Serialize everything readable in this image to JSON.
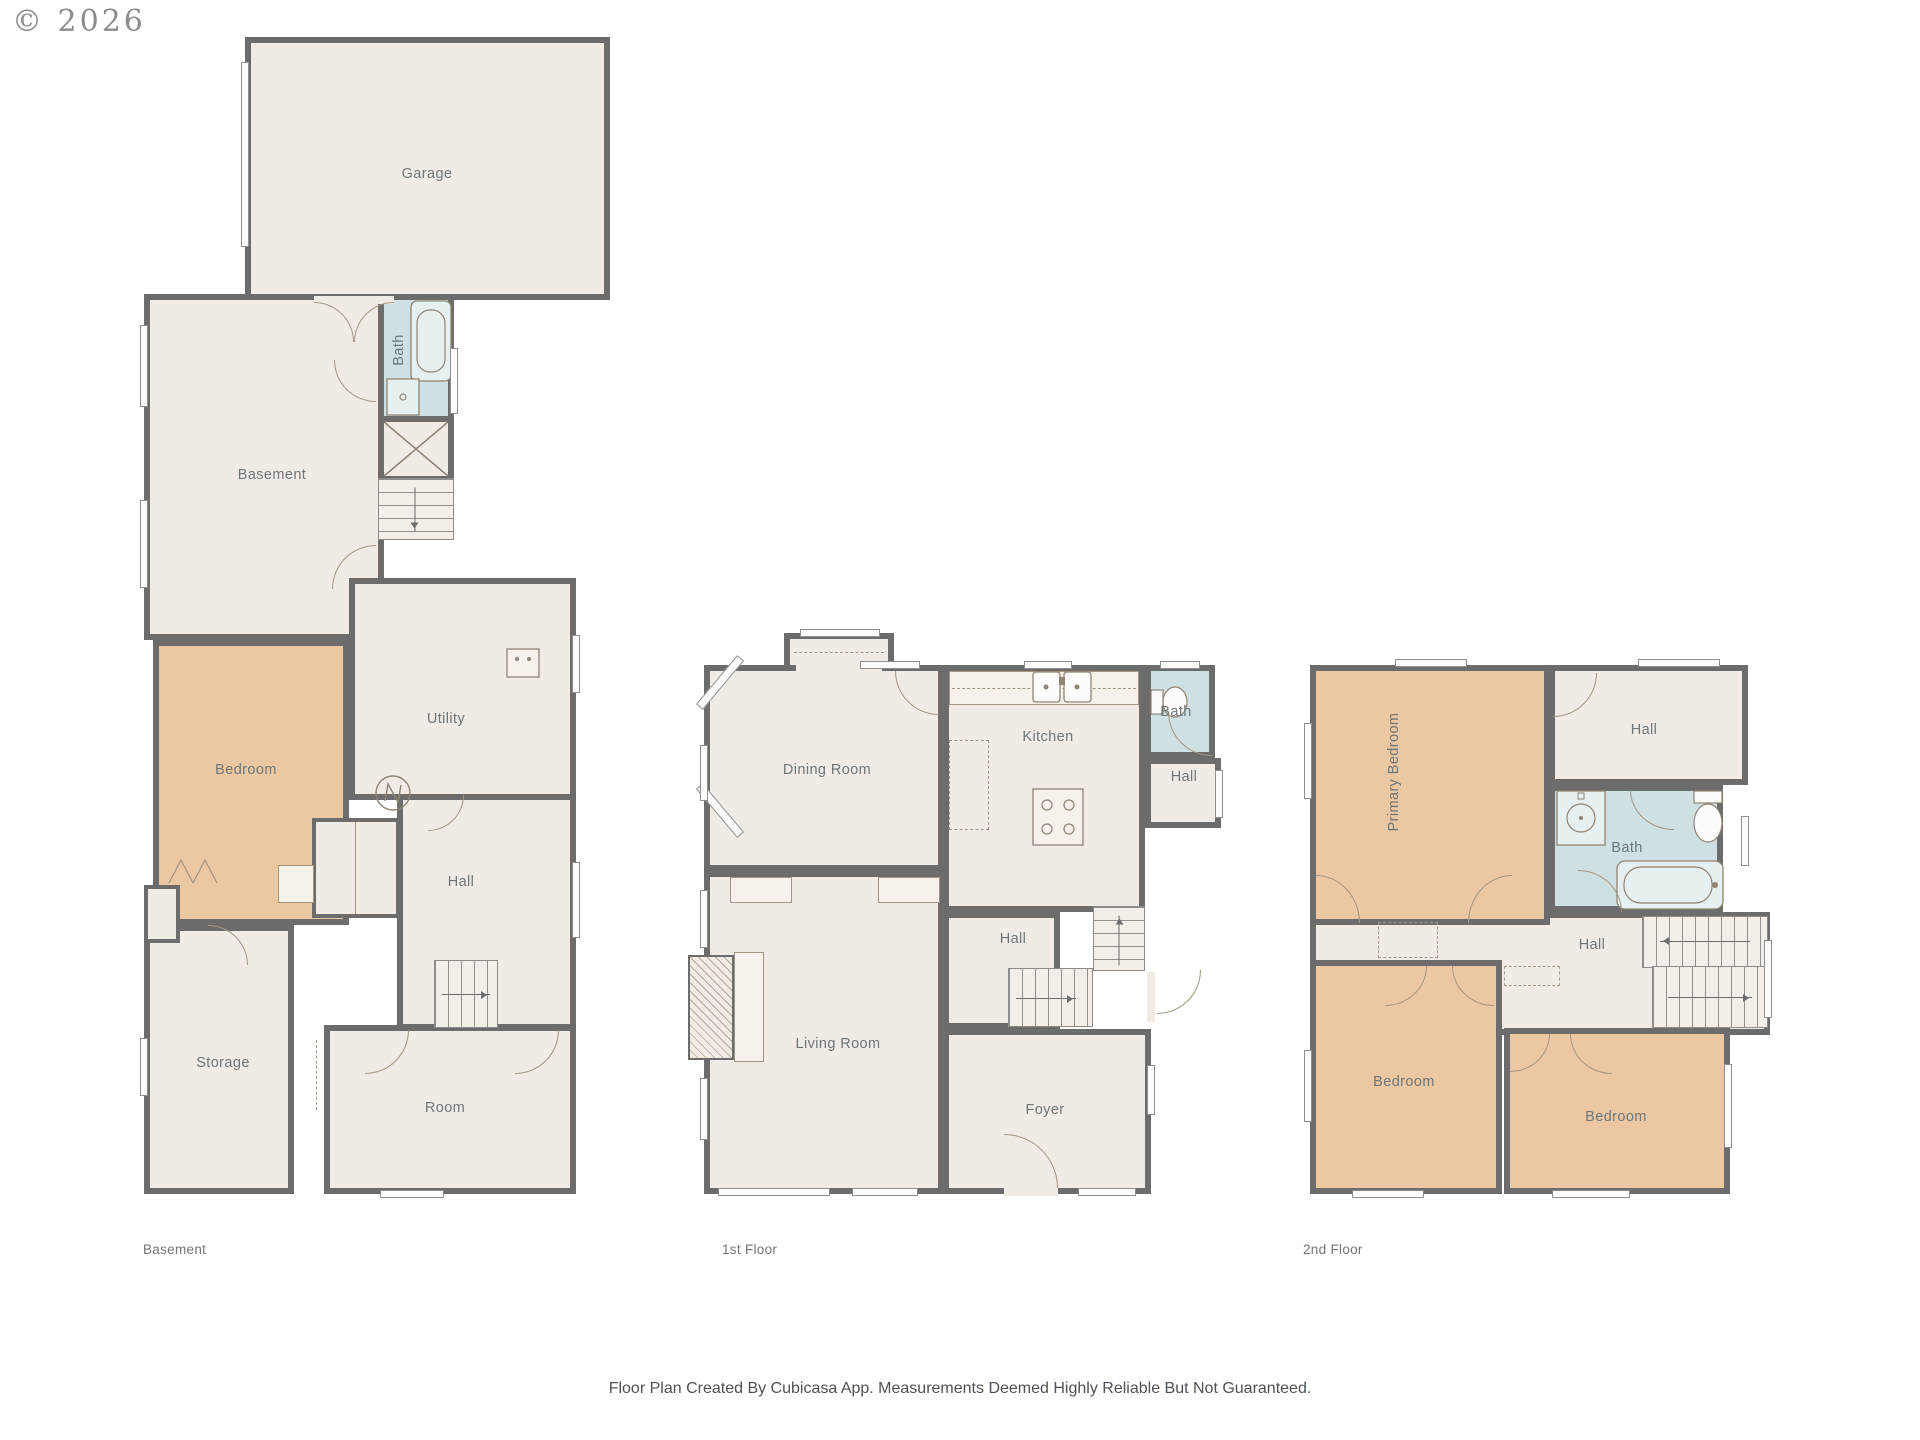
{
  "watermark": "© 2026",
  "footer": "Floor Plan Created By Cubicasa App. Measurements Deemed Highly Reliable But Not Guaranteed.",
  "colors": {
    "wall": "#6c6c6c",
    "room_fill": "#f1ebe5",
    "bedroom_fill": "#ecc8a2",
    "bath_fill": "#cfe0e2",
    "label_text": "#6d7678",
    "background": "#ffffff"
  },
  "floors": {
    "basement": {
      "caption": "Basement",
      "rooms": {
        "garage": "Garage",
        "bath": "Bath",
        "basement": "Basement",
        "utility": "Utility",
        "bedroom": "Bedroom",
        "hall": "Hall",
        "storage": "Storage",
        "room": "Room"
      }
    },
    "first": {
      "caption": "1st Floor",
      "rooms": {
        "dining_room": "Dining Room",
        "kitchen": "Kitchen",
        "bath": "Bath",
        "hall_upper": "Hall",
        "hall": "Hall",
        "living_room": "Living Room",
        "foyer": "Foyer"
      }
    },
    "second": {
      "caption": "2nd Floor",
      "rooms": {
        "primary_bedroom": "Primary Bedroom",
        "hall_upper": "Hall",
        "bath": "Bath",
        "hall": "Hall",
        "bedroom_left": "Bedroom",
        "bedroom_right": "Bedroom"
      }
    }
  }
}
